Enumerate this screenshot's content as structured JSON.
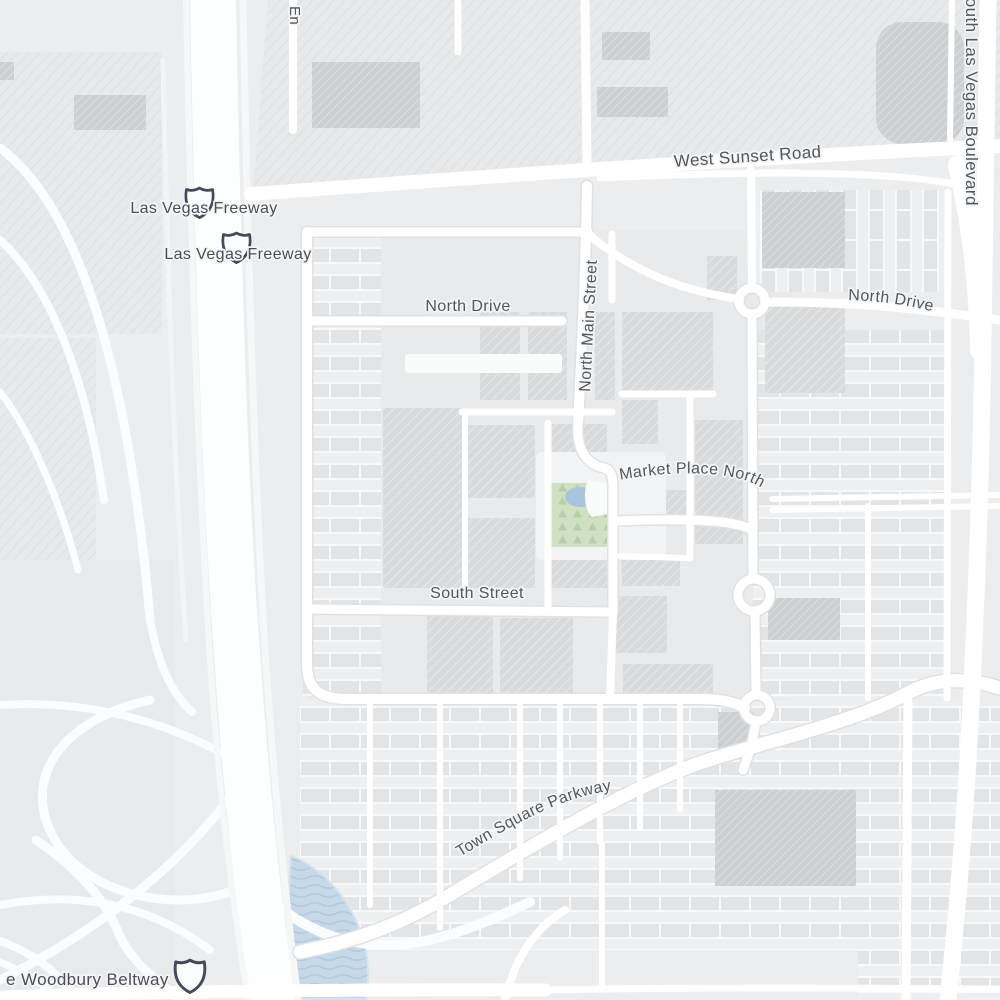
{
  "map": {
    "kind": "street-map",
    "labels": {
      "partial_top": {
        "text": "En"
      },
      "west_sunset_road": {
        "text": "West Sunset Road"
      },
      "south_las_vegas_blvd": {
        "text": "South Las Vegas Boulevard"
      },
      "las_vegas_freeway_1": {
        "text": "Las Vegas Freeway"
      },
      "las_vegas_freeway_2": {
        "text": "Las Vegas Freeway"
      },
      "north_drive_west": {
        "text": "North Drive"
      },
      "north_drive_east": {
        "text": "North Drive"
      },
      "north_main_street": {
        "text": "North Main Street"
      },
      "market_place_north": {
        "text": "Market Place North"
      },
      "south_street": {
        "text": "South Street"
      },
      "town_square_parkway": {
        "text": "Town Square Parkway"
      },
      "woodbury_beltway": {
        "text": "e Woodbury Beltway"
      }
    },
    "shields": {
      "style": "interstate",
      "count": 3
    },
    "colors": {
      "land": "#ebedee",
      "road": "#ffffff",
      "parking": "#e2e4e6",
      "building": "#d8dadc",
      "building_dark": "#ced1d3",
      "park": "#cfe0c3",
      "water": "#c7d9e8",
      "pond": "#a9c4de",
      "label": "#54575c",
      "shield_outline": "#474a5c"
    }
  }
}
